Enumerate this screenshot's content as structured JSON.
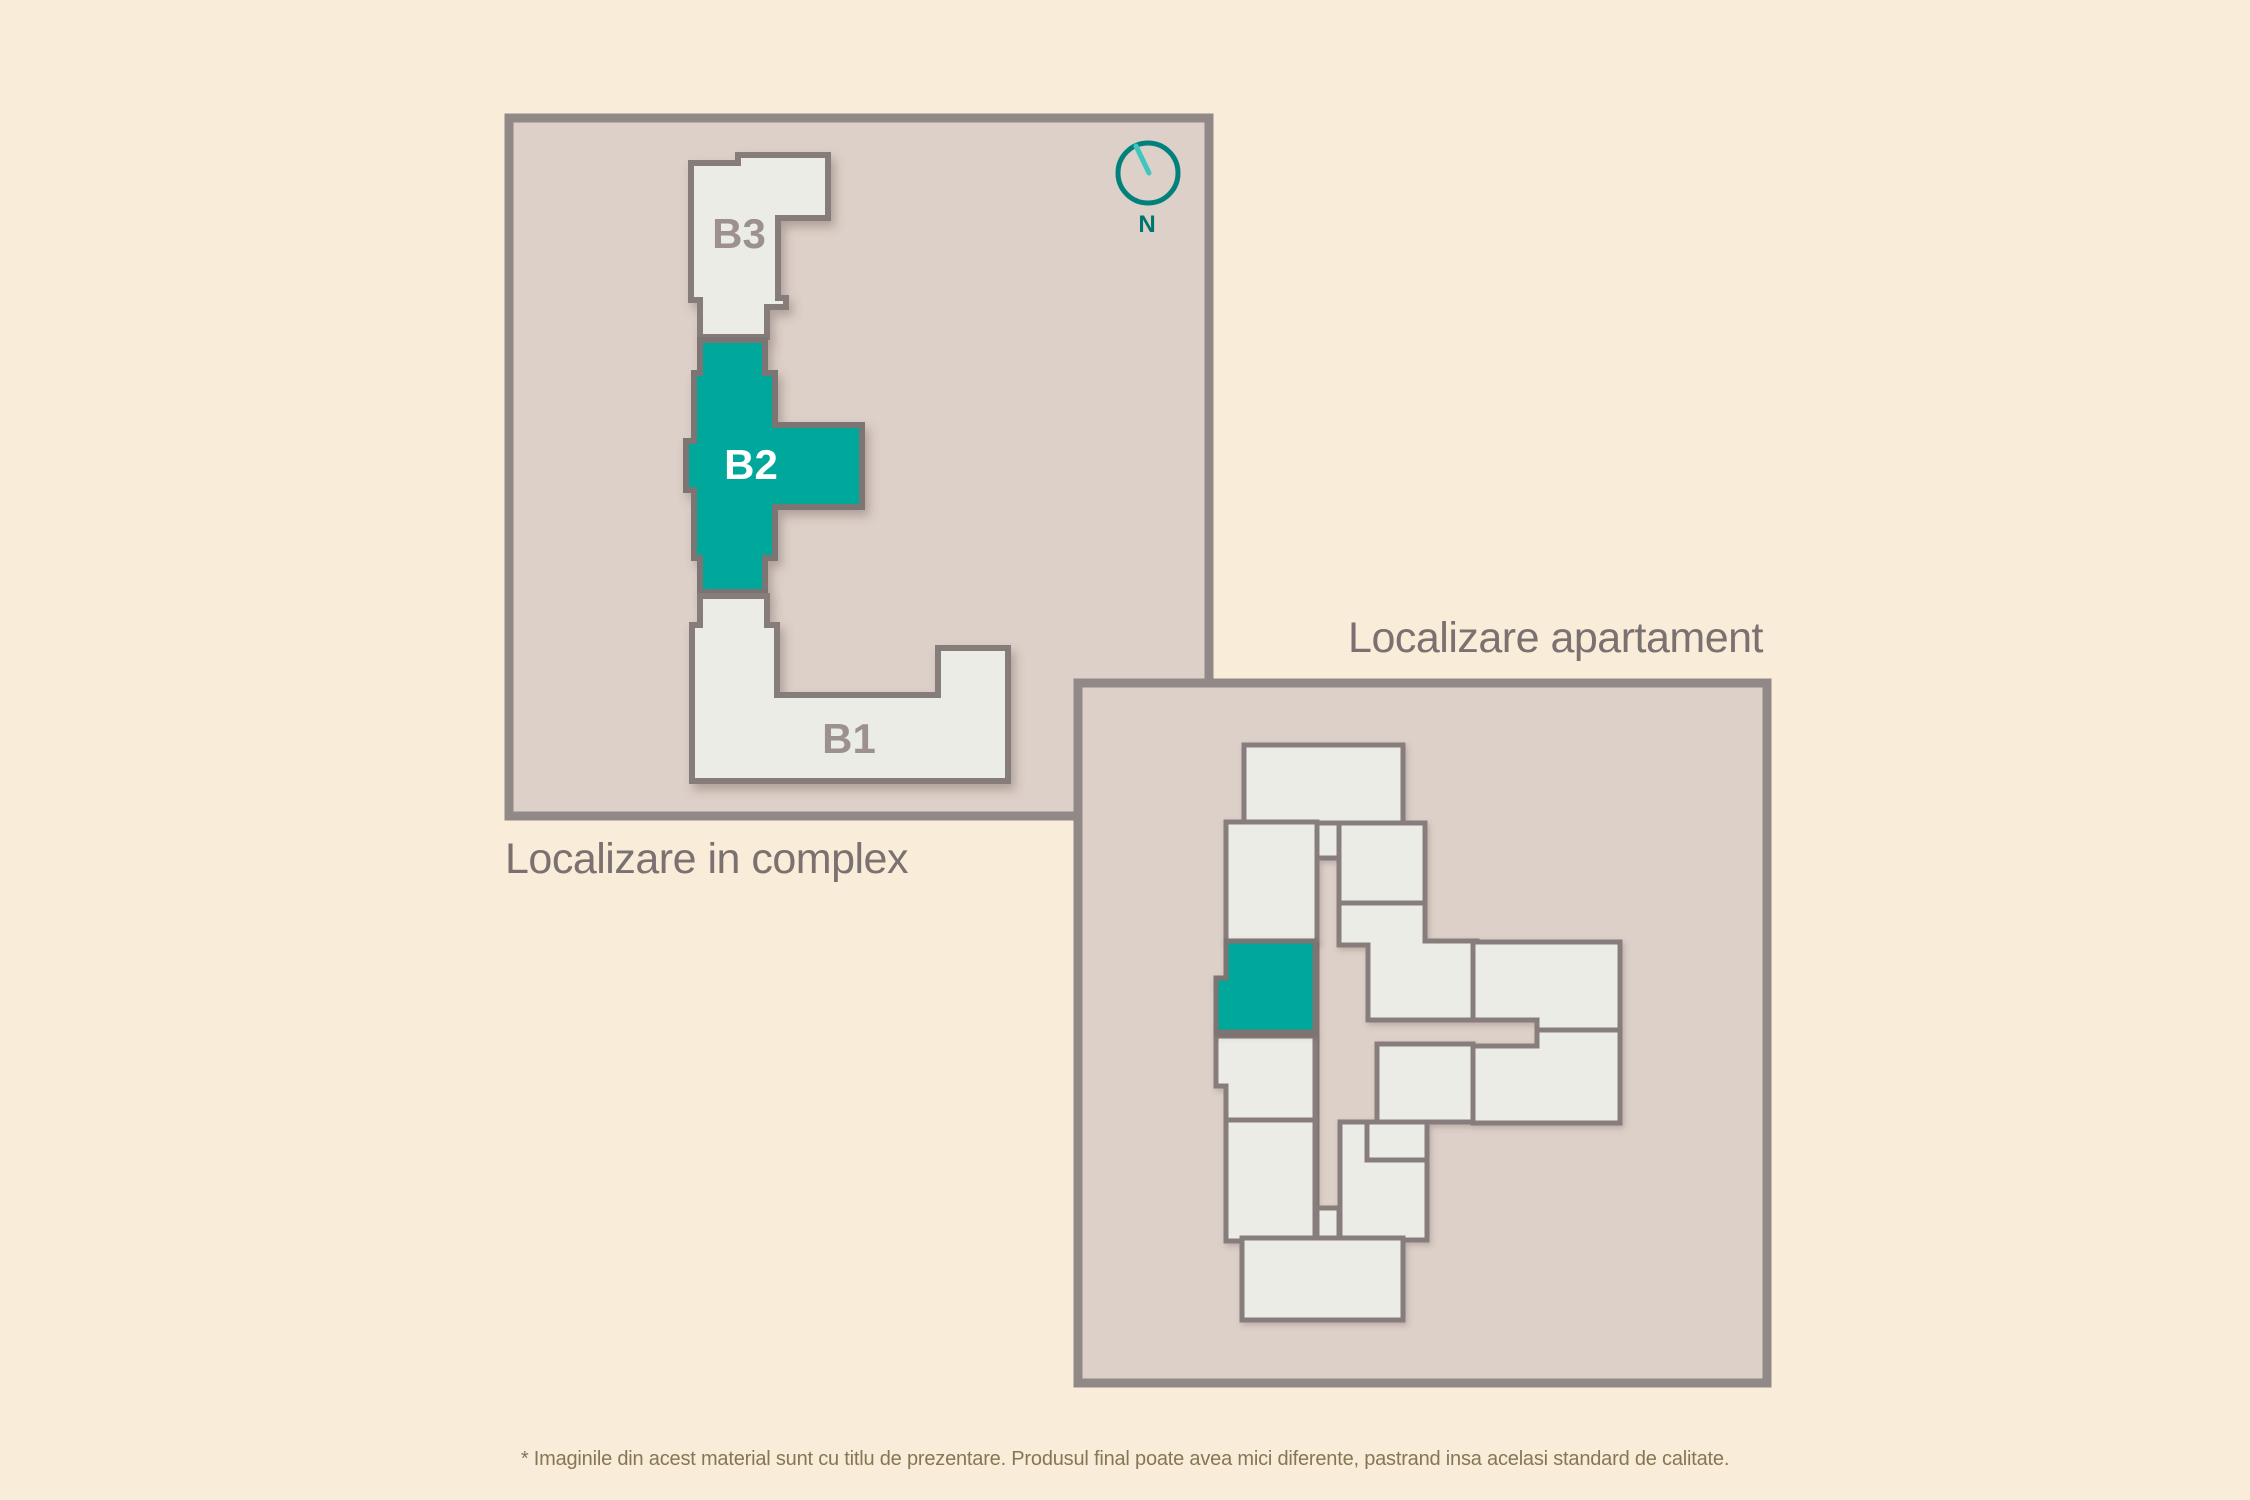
{
  "colors": {
    "background": "#f9edda",
    "panel_fill": "#ddd0c8",
    "panel_border": "#918988",
    "building_fill": "#ecece7",
    "building_border": "#867c7a",
    "highlight": "#00a89c",
    "room_fill": "#ecece7",
    "room_border": "#877d7b",
    "label_muted": "#9c918e",
    "label_on_highlight": "#ffffff",
    "title_text": "#7b7170",
    "compass_ring": "#00817b",
    "compass_needle": "#3ec6bf",
    "compass_label_color": "#00756f",
    "disclaimer_text": "#867655"
  },
  "complex_map": {
    "title": "Localizare in complex",
    "highlighted_building": "B2",
    "building_labels": {
      "b3": "B3",
      "b2": "B2",
      "b1": "B1"
    },
    "compass": {
      "label": "N"
    }
  },
  "apartment_map": {
    "title": "Localizare apartament",
    "highlighted_room": "apartment"
  },
  "footer": {
    "disclaimer": "* Imaginile din acest material sunt cu titlu de prezentare. Produsul final poate avea mici diferente, pastrand insa acelasi standard de calitate."
  }
}
